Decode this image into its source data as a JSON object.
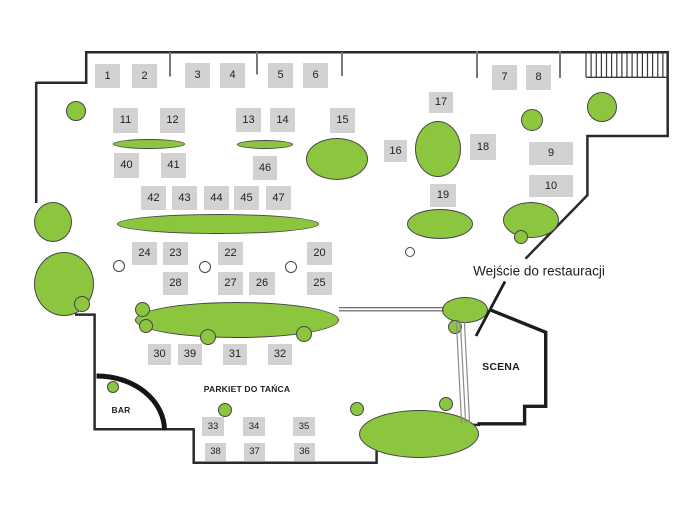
{
  "colors": {
    "green": "#8CC63E",
    "green_border": "#454547",
    "table_gray": "#D2D2D2",
    "wall": "#2B2B2D",
    "tick_gray": "#77787B",
    "rail_gray": "#8A8B8E",
    "text": "#1F1F21"
  },
  "labels": {
    "bar": "BAR",
    "dance_floor": "PARKIET DO TAŃCA",
    "stage": "SCENA",
    "entrance": "Wejście do restauracji"
  },
  "tables": [
    {
      "n": "1",
      "x": 95,
      "y": 64,
      "w": 25,
      "h": 24
    },
    {
      "n": "2",
      "x": 132,
      "y": 64,
      "w": 25,
      "h": 24
    },
    {
      "n": "3",
      "x": 185,
      "y": 63,
      "w": 25,
      "h": 25
    },
    {
      "n": "4",
      "x": 220,
      "y": 63,
      "w": 25,
      "h": 25
    },
    {
      "n": "5",
      "x": 268,
      "y": 63,
      "w": 25,
      "h": 25
    },
    {
      "n": "6",
      "x": 303,
      "y": 63,
      "w": 25,
      "h": 25
    },
    {
      "n": "7",
      "x": 492,
      "y": 65,
      "w": 25,
      "h": 25
    },
    {
      "n": "8",
      "x": 526,
      "y": 65,
      "w": 25,
      "h": 25
    },
    {
      "n": "9",
      "x": 529,
      "y": 142,
      "w": 44,
      "h": 23
    },
    {
      "n": "10",
      "x": 529,
      "y": 175,
      "w": 44,
      "h": 22
    },
    {
      "n": "11",
      "x": 113,
      "y": 108,
      "w": 25,
      "h": 25
    },
    {
      "n": "12",
      "x": 160,
      "y": 108,
      "w": 25,
      "h": 25
    },
    {
      "n": "13",
      "x": 236,
      "y": 108,
      "w": 25,
      "h": 24
    },
    {
      "n": "14",
      "x": 270,
      "y": 108,
      "w": 25,
      "h": 24
    },
    {
      "n": "15",
      "x": 330,
      "y": 108,
      "w": 25,
      "h": 25
    },
    {
      "n": "16",
      "x": 384,
      "y": 140,
      "w": 23,
      "h": 22
    },
    {
      "n": "17",
      "x": 429,
      "y": 92,
      "w": 24,
      "h": 21
    },
    {
      "n": "18",
      "x": 470,
      "y": 134,
      "w": 26,
      "h": 26
    },
    {
      "n": "19",
      "x": 430,
      "y": 184,
      "w": 26,
      "h": 23
    },
    {
      "n": "20",
      "x": 307,
      "y": 242,
      "w": 25,
      "h": 23
    },
    {
      "n": "22",
      "x": 218,
      "y": 242,
      "w": 25,
      "h": 23
    },
    {
      "n": "23",
      "x": 163,
      "y": 242,
      "w": 25,
      "h": 23
    },
    {
      "n": "24",
      "x": 132,
      "y": 242,
      "w": 25,
      "h": 23
    },
    {
      "n": "25",
      "x": 307,
      "y": 272,
      "w": 25,
      "h": 23
    },
    {
      "n": "26",
      "x": 249,
      "y": 272,
      "w": 26,
      "h": 23
    },
    {
      "n": "27",
      "x": 218,
      "y": 272,
      "w": 25,
      "h": 23
    },
    {
      "n": "28",
      "x": 163,
      "y": 272,
      "w": 25,
      "h": 23
    },
    {
      "n": "30",
      "x": 148,
      "y": 344,
      "w": 23,
      "h": 21
    },
    {
      "n": "31",
      "x": 223,
      "y": 344,
      "w": 24,
      "h": 21
    },
    {
      "n": "32",
      "x": 268,
      "y": 344,
      "w": 24,
      "h": 21
    },
    {
      "n": "33",
      "x": 202,
      "y": 417,
      "w": 22,
      "h": 19
    },
    {
      "n": "34",
      "x": 243,
      "y": 417,
      "w": 22,
      "h": 19
    },
    {
      "n": "35",
      "x": 293,
      "y": 417,
      "w": 22,
      "h": 19
    },
    {
      "n": "36",
      "x": 294,
      "y": 443,
      "w": 21,
      "h": 18
    },
    {
      "n": "37",
      "x": 244,
      "y": 443,
      "w": 21,
      "h": 18
    },
    {
      "n": "38",
      "x": 205,
      "y": 443,
      "w": 21,
      "h": 18
    },
    {
      "n": "39",
      "x": 178,
      "y": 344,
      "w": 24,
      "h": 21
    },
    {
      "n": "40",
      "x": 114,
      "y": 153,
      "w": 25,
      "h": 25
    },
    {
      "n": "41",
      "x": 161,
      "y": 153,
      "w": 25,
      "h": 25
    },
    {
      "n": "42",
      "x": 141,
      "y": 186,
      "w": 25,
      "h": 24
    },
    {
      "n": "43",
      "x": 172,
      "y": 186,
      "w": 25,
      "h": 24
    },
    {
      "n": "44",
      "x": 204,
      "y": 186,
      "w": 25,
      "h": 24
    },
    {
      "n": "45",
      "x": 234,
      "y": 186,
      "w": 25,
      "h": 24
    },
    {
      "n": "46",
      "x": 253,
      "y": 156,
      "w": 24,
      "h": 24
    },
    {
      "n": "47",
      "x": 266,
      "y": 186,
      "w": 25,
      "h": 24
    }
  ],
  "plants": [
    {
      "cx": 149,
      "cy": 143.5,
      "rx": 36,
      "ry": 5
    },
    {
      "cx": 265,
      "cy": 144.5,
      "rx": 28,
      "ry": 4.5
    },
    {
      "cx": 337,
      "cy": 159,
      "rx": 31,
      "ry": 21
    },
    {
      "cx": 438,
      "cy": 149,
      "rx": 23,
      "ry": 28
    },
    {
      "cx": 440,
      "cy": 224,
      "rx": 33,
      "ry": 15
    },
    {
      "cx": 531,
      "cy": 220,
      "rx": 28,
      "ry": 18
    },
    {
      "cx": 218,
      "cy": 224,
      "rx": 101,
      "ry": 10
    },
    {
      "cx": 237,
      "cy": 320,
      "rx": 102,
      "ry": 18
    },
    {
      "cx": 465,
      "cy": 310,
      "rx": 23,
      "ry": 13
    },
    {
      "cx": 419,
      "cy": 434,
      "rx": 60,
      "ry": 24
    },
    {
      "cx": 76,
      "cy": 111,
      "rx": 10,
      "ry": 10
    },
    {
      "cx": 53,
      "cy": 222,
      "rx": 19,
      "ry": 20
    },
    {
      "cx": 64,
      "cy": 284,
      "rx": 30,
      "ry": 32
    },
    {
      "cx": 602,
      "cy": 107,
      "rx": 15,
      "ry": 15
    },
    {
      "cx": 532,
      "cy": 120,
      "rx": 11,
      "ry": 11
    },
    {
      "cx": 113,
      "cy": 387,
      "rx": 6,
      "ry": 6
    },
    {
      "cx": 225,
      "cy": 410,
      "rx": 7,
      "ry": 7
    },
    {
      "cx": 357,
      "cy": 409,
      "rx": 7,
      "ry": 7
    },
    {
      "cx": 446,
      "cy": 404,
      "rx": 7,
      "ry": 7
    },
    {
      "cx": 455,
      "cy": 327,
      "rx": 7,
      "ry": 7
    },
    {
      "cx": 521,
      "cy": 237,
      "rx": 7,
      "ry": 7
    },
    {
      "cx": 142,
      "cy": 309,
      "rx": 7.5,
      "ry": 7.5
    },
    {
      "cx": 146,
      "cy": 326,
      "rx": 7,
      "ry": 7
    },
    {
      "cx": 208,
      "cy": 337,
      "rx": 8,
      "ry": 8
    },
    {
      "cx": 304,
      "cy": 334,
      "rx": 8,
      "ry": 8
    },
    {
      "cx": 82,
      "cy": 304,
      "rx": 8,
      "ry": 8
    }
  ],
  "chairs": [
    {
      "cx": 119,
      "cy": 266,
      "r": 6
    },
    {
      "cx": 205,
      "cy": 267,
      "r": 6
    },
    {
      "cx": 291,
      "cy": 267,
      "r": 6
    },
    {
      "cx": 410,
      "cy": 252,
      "r": 5
    }
  ]
}
